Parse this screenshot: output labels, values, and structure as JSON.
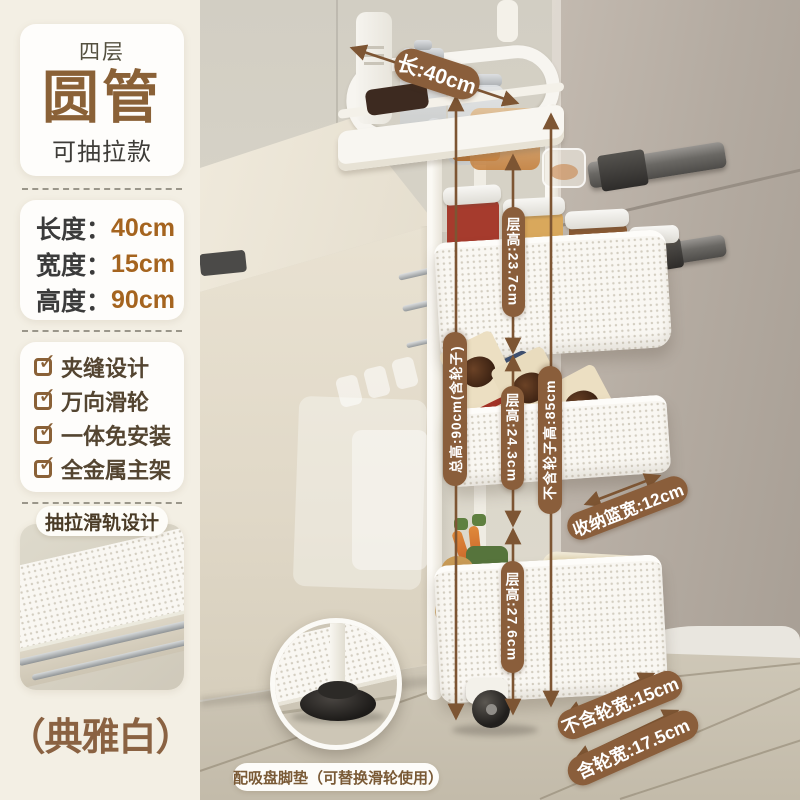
{
  "sidebar": {
    "badge": {
      "top": "四层",
      "title": "圆管",
      "subtitle": "可抽拉款"
    },
    "dimensions": {
      "rows": [
        {
          "label": "长度：",
          "value": "40cm"
        },
        {
          "label": "宽度：",
          "value": "15cm"
        },
        {
          "label": "高度：",
          "value": "90cm"
        }
      ]
    },
    "features": {
      "check": "✓",
      "items": [
        "夹缝设计",
        "万向滑轮",
        "一体免安装",
        "全金属主架"
      ]
    },
    "slide_design_title": "抽拉滑轨设计",
    "color_name": "（典雅白）"
  },
  "photo": {
    "annotations": {
      "length": "长:40cm",
      "total_height": "总高:90cm(含轮子)",
      "tier1_height": "层高:23.7cm",
      "tier2_height": "层高:24.3cm",
      "tier3_height": "层高:27.6cm",
      "height_no_wheels": "不含轮子高:85cm",
      "basket_width": "收纳篮宽:12cm",
      "width_no_wheels": "不含轮宽:15cm",
      "width_with_wheels": "含轮宽:17.5cm"
    },
    "bread_label": "DINKEL",
    "caption": "配吸盘脚垫（可替换滑轮使用）"
  },
  "colors": {
    "accent_brown": "#8a5e3b",
    "text_brown": "#8a6137",
    "value_orange": "#a5641f",
    "sidebar_bg": "#f3efe4"
  }
}
